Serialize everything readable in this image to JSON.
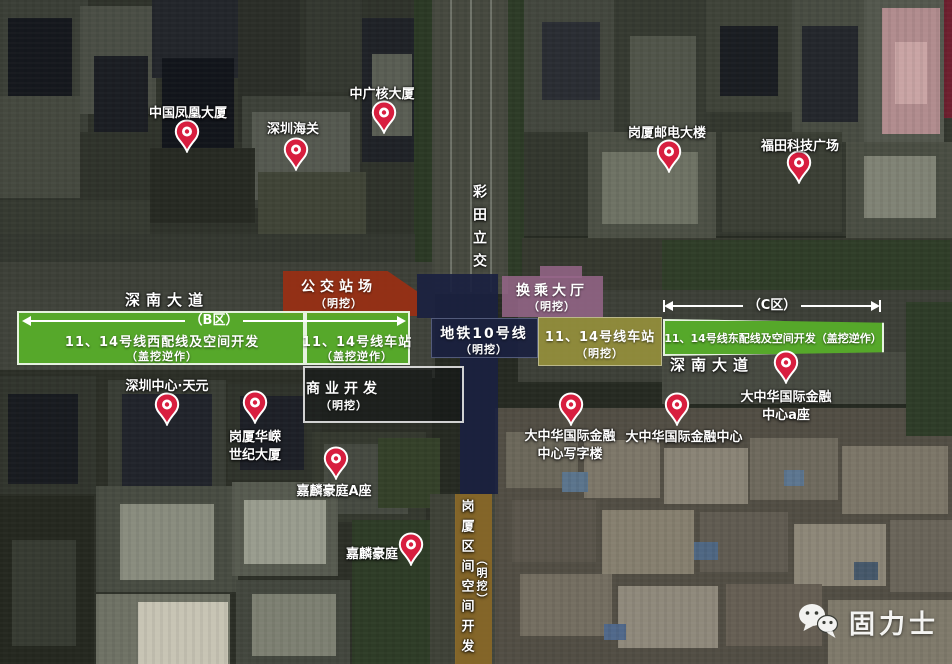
{
  "canvas": {
    "width": 952,
    "height": 664
  },
  "colors": {
    "pin_red": "#d81e3f",
    "zone_green": "rgba(88,177,41,0.92)",
    "zone_red": "rgba(158,45,17,0.88)",
    "zone_mauve": "rgba(151,102,137,0.85)",
    "zone_navy": "rgba(26,33,64,0.92)",
    "zone_olive": "rgba(160,154,60,0.82)",
    "zone_gold": "rgba(148,112,42,0.85)",
    "zone_dark_outline": "rgba(10,12,16,0.42)"
  },
  "background": {
    "base": "#262a22",
    "blocks": [
      [
        0,
        0,
        432,
        292,
        "#2f332b"
      ],
      [
        0,
        0,
        88,
        132,
        "#3b3f37"
      ],
      [
        8,
        18,
        64,
        96,
        "#15181d"
      ],
      [
        80,
        6,
        76,
        108,
        "#4a4e45"
      ],
      [
        94,
        56,
        54,
        76,
        "#1b1e23"
      ],
      [
        152,
        0,
        108,
        78,
        "#23262b"
      ],
      [
        162,
        58,
        72,
        118,
        "#12151b"
      ],
      [
        238,
        0,
        62,
        142,
        "#2b2e28"
      ],
      [
        242,
        96,
        118,
        112,
        "#3d4139"
      ],
      [
        252,
        112,
        98,
        88,
        "#555950"
      ],
      [
        306,
        0,
        56,
        92,
        "#343830"
      ],
      [
        362,
        18,
        54,
        144,
        "#1f2227"
      ],
      [
        372,
        54,
        40,
        82,
        "#5a5e54"
      ],
      [
        0,
        96,
        80,
        102,
        "#45493f"
      ],
      [
        0,
        200,
        150,
        62,
        "#363a31"
      ],
      [
        150,
        148,
        105,
        75,
        "#272a23"
      ],
      [
        258,
        172,
        108,
        62,
        "#404437"
      ],
      [
        414,
        0,
        20,
        292,
        "#2b3925"
      ],
      [
        432,
        0,
        76,
        294,
        "#46493f"
      ],
      [
        450,
        0,
        2,
        292,
        "#70746a"
      ],
      [
        470,
        0,
        2,
        292,
        "#70746a"
      ],
      [
        490,
        0,
        2,
        292,
        "#70746a"
      ],
      [
        508,
        0,
        16,
        290,
        "#2d3b27"
      ],
      [
        524,
        0,
        432,
        236,
        "#33372e"
      ],
      [
        524,
        0,
        92,
        132,
        "#43473e"
      ],
      [
        542,
        22,
        58,
        78,
        "#2a2d33"
      ],
      [
        614,
        0,
        96,
        152,
        "#363a31"
      ],
      [
        630,
        36,
        66,
        92,
        "#51554a"
      ],
      [
        706,
        0,
        88,
        112,
        "#3f4339"
      ],
      [
        720,
        26,
        58,
        70,
        "#1a1d22"
      ],
      [
        792,
        0,
        76,
        142,
        "#484c42"
      ],
      [
        802,
        26,
        56,
        96,
        "#24272c"
      ],
      [
        864,
        0,
        80,
        172,
        "#54584e"
      ],
      [
        882,
        8,
        58,
        126,
        "#b18c8e"
      ],
      [
        895,
        42,
        32,
        62,
        "#c9a4a4"
      ],
      [
        944,
        0,
        8,
        118,
        "#6e1f2e"
      ],
      [
        588,
        132,
        128,
        106,
        "#4c5045"
      ],
      [
        602,
        152,
        96,
        72,
        "#6e7264"
      ],
      [
        722,
        132,
        120,
        100,
        "#3b3f35"
      ],
      [
        846,
        142,
        106,
        96,
        "#4a4e43"
      ],
      [
        864,
        156,
        72,
        62,
        "#808375"
      ],
      [
        0,
        234,
        415,
        58,
        "#343830"
      ],
      [
        0,
        262,
        432,
        32,
        "#3d4038"
      ],
      [
        522,
        238,
        430,
        56,
        "#36392f"
      ],
      [
        662,
        240,
        288,
        54,
        "#2f3d28"
      ],
      [
        0,
        290,
        435,
        88,
        "#40433b"
      ],
      [
        518,
        290,
        434,
        92,
        "#3d4038"
      ],
      [
        662,
        352,
        290,
        52,
        "#474a41"
      ],
      [
        0,
        370,
        432,
        294,
        "#2c2f27"
      ],
      [
        0,
        376,
        96,
        118,
        "#31352d"
      ],
      [
        8,
        394,
        70,
        90,
        "#181b20"
      ],
      [
        108,
        380,
        118,
        126,
        "#393d35"
      ],
      [
        122,
        394,
        90,
        102,
        "#21242b"
      ],
      [
        228,
        384,
        94,
        96,
        "#2f332b"
      ],
      [
        240,
        396,
        64,
        74,
        "#1d2027"
      ],
      [
        312,
        432,
        114,
        90,
        "#35392f"
      ],
      [
        324,
        444,
        84,
        70,
        "#464a41"
      ],
      [
        96,
        486,
        142,
        106,
        "#484c42"
      ],
      [
        120,
        504,
        94,
        76,
        "#898c7e"
      ],
      [
        0,
        496,
        94,
        168,
        "#252820"
      ],
      [
        12,
        540,
        64,
        106,
        "#373b32"
      ],
      [
        96,
        594,
        134,
        70,
        "#6f7265"
      ],
      [
        138,
        602,
        90,
        62,
        "#c7c4b4"
      ],
      [
        232,
        482,
        106,
        94,
        "#575b50"
      ],
      [
        244,
        500,
        82,
        64,
        "#999c8e"
      ],
      [
        236,
        580,
        114,
        84,
        "#43473e"
      ],
      [
        252,
        594,
        84,
        62,
        "#7d8072"
      ],
      [
        352,
        520,
        80,
        144,
        "#2e3c27"
      ],
      [
        378,
        438,
        62,
        70,
        "#344029"
      ],
      [
        430,
        494,
        26,
        170,
        "#3f4238"
      ],
      [
        492,
        494,
        32,
        170,
        "#42453c"
      ],
      [
        495,
        408,
        457,
        256,
        "#524e44"
      ],
      [
        506,
        432,
        72,
        56,
        "#6c685b"
      ],
      [
        584,
        440,
        76,
        58,
        "#7d7769"
      ],
      [
        664,
        448,
        84,
        56,
        "#8a8476"
      ],
      [
        750,
        438,
        88,
        62,
        "#6f6a5e"
      ],
      [
        842,
        446,
        106,
        68,
        "#7c7668"
      ],
      [
        512,
        500,
        84,
        62,
        "#5b564c"
      ],
      [
        602,
        510,
        92,
        64,
        "#867f6f"
      ],
      [
        700,
        512,
        88,
        60,
        "#615c52"
      ],
      [
        794,
        524,
        92,
        62,
        "#8d8778"
      ],
      [
        890,
        520,
        62,
        72,
        "#6a655a"
      ],
      [
        520,
        574,
        92,
        62,
        "#746e61"
      ],
      [
        618,
        586,
        100,
        62,
        "#8f897b"
      ],
      [
        726,
        584,
        96,
        62,
        "#665f54"
      ],
      [
        828,
        600,
        124,
        64,
        "#7f7a6b"
      ],
      [
        562,
        472,
        26,
        20,
        "#5b748c"
      ],
      [
        694,
        542,
        24,
        18,
        "#4f6783"
      ],
      [
        784,
        470,
        20,
        16,
        "#5d7690"
      ],
      [
        854,
        562,
        24,
        18,
        "#46586a"
      ],
      [
        604,
        624,
        22,
        16,
        "#50688a"
      ],
      [
        906,
        302,
        46,
        134,
        "#2e3c28"
      ]
    ]
  },
  "zones": [
    {
      "name": "bus-depot-zone",
      "color": "rgba(158,45,17,0.88)",
      "parts": [
        {
          "x": 283,
          "y": 271,
          "w": 134,
          "h": 45,
          "clip": "polygon(0% 0%,78% 0%,100% 45%,100% 100%,0% 100%)"
        }
      ],
      "texts": [
        {
          "t": "公交站场",
          "x": 339,
          "y": 276,
          "s": 14,
          "ls": 5
        },
        {
          "t": "（明挖）",
          "x": 339,
          "y": 295,
          "s": 11,
          "ls": 1
        }
      ]
    },
    {
      "name": "transfer-hall-zone",
      "color": "rgba(151,102,137,0.85)",
      "parts": [
        {
          "x": 540,
          "y": 266,
          "w": 42,
          "h": 12
        },
        {
          "x": 502,
          "y": 276,
          "w": 101,
          "h": 41
        }
      ],
      "texts": [
        {
          "t": "换乘大厅",
          "x": 552,
          "y": 280,
          "s": 14,
          "ls": 4
        },
        {
          "t": "（明挖）",
          "x": 552,
          "y": 298,
          "s": 11,
          "ls": 1
        }
      ]
    },
    {
      "name": "west-dev-zone",
      "color": "rgba(88,177,41,0.92)",
      "parts": [
        {
          "x": 17,
          "y": 311,
          "w": 288,
          "h": 54,
          "border": "2px solid rgba(255,255,255,0.85)"
        }
      ],
      "texts": [
        {
          "t": "11、14号线西配线及空间开发",
          "x": 162,
          "y": 331,
          "s": 13,
          "ls": 1
        },
        {
          "t": "（盖挖逆作）",
          "x": 162,
          "y": 348,
          "s": 11,
          "ls": 1
        }
      ]
    },
    {
      "name": "west-station-zone",
      "color": "rgba(88,177,41,0.92)",
      "parts": [
        {
          "x": 305,
          "y": 311,
          "w": 105,
          "h": 54,
          "border": "2px solid rgba(255,255,255,0.85)"
        }
      ],
      "texts": [
        {
          "t": "11、14号线车站",
          "x": 357,
          "y": 331,
          "s": 13,
          "ls": 1
        },
        {
          "t": "（盖挖逆作）",
          "x": 357,
          "y": 348,
          "s": 11,
          "ls": 1
        }
      ]
    },
    {
      "name": "metro-line10-zone",
      "color": "rgba(26,33,64,0.92)",
      "parts": [
        {
          "x": 417,
          "y": 274,
          "w": 81,
          "h": 44
        },
        {
          "x": 431,
          "y": 318,
          "w": 107,
          "h": 40,
          "border": "1px solid rgba(150,160,195,0.45)"
        },
        {
          "x": 460,
          "y": 358,
          "w": 38,
          "h": 136
        }
      ],
      "texts": [
        {
          "t": "地铁10号线",
          "x": 484,
          "y": 323,
          "s": 14,
          "ls": 2
        },
        {
          "t": "（明挖）",
          "x": 484,
          "y": 341,
          "s": 11,
          "ls": 1
        }
      ]
    },
    {
      "name": "east-station-zone",
      "color": "rgba(160,154,60,0.82)",
      "parts": [
        {
          "x": 538,
          "y": 317,
          "w": 124,
          "h": 49,
          "border": "1px solid rgba(255,255,255,0.4)"
        }
      ],
      "texts": [
        {
          "t": "11、14号线车站",
          "x": 600,
          "y": 326,
          "s": 13,
          "ls": 1
        },
        {
          "t": "（明挖）",
          "x": 600,
          "y": 345,
          "s": 11,
          "ls": 1
        }
      ]
    },
    {
      "name": "east-dev-zone",
      "color": "rgba(88,177,41,0.92)",
      "parts": [
        {
          "x": 663,
          "y": 319,
          "w": 221,
          "h": 37,
          "border": "2px solid rgba(255,255,255,0.85)",
          "clip": "polygon(0% 0%,100% 10%,100% 90%,0% 100%)"
        }
      ],
      "texts": [
        {
          "t": "11、14号线东配线及空间开发（盖挖逆作）",
          "x": 773,
          "y": 330,
          "s": 11,
          "ls": 0
        }
      ]
    },
    {
      "name": "commercial-dev-zone",
      "color": "rgba(10,12,16,0.42)",
      "parts": [
        {
          "x": 303,
          "y": 366,
          "w": 161,
          "h": 57,
          "border": "2px solid rgba(242,242,242,0.85)"
        }
      ],
      "texts": [
        {
          "t": "商业开发",
          "x": 344,
          "y": 378,
          "s": 14,
          "ls": 5
        },
        {
          "t": "（明挖）",
          "x": 344,
          "y": 397,
          "s": 11,
          "ls": 1
        }
      ]
    },
    {
      "name": "gangxia-interval-zone",
      "color": "rgba(148,112,42,0.85)",
      "parts": [
        {
          "x": 455,
          "y": 494,
          "w": 37,
          "h": 170
        }
      ],
      "texts": []
    }
  ],
  "arrows": [
    {
      "name": "zone-b-extent-arrow",
      "label": "（B区）",
      "x1": 22,
      "x2": 406,
      "y": 321,
      "ticks": false,
      "shadow": false
    },
    {
      "name": "zone-c-extent-arrow",
      "label": "（C区）",
      "x1": 664,
      "x2": 880,
      "y": 306,
      "ticks": true,
      "shadow": true
    }
  ],
  "road_labels": [
    {
      "t": "深南大道",
      "x": 167,
      "y": 289,
      "s": 15,
      "ls": 6
    },
    {
      "t": "深南大道",
      "x": 712,
      "y": 354,
      "s": 15,
      "ls": 6
    }
  ],
  "vertical_labels": [
    {
      "t": "彩田立交",
      "x": 479,
      "y": 184,
      "s": 14,
      "gap": 9
    },
    {
      "t": "岗厦区间空间开发",
      "x": 466,
      "y": 499,
      "s": 13,
      "gap": 7
    },
    {
      "t": "（明挖）",
      "x": 481,
      "y": 554,
      "s": 11,
      "gap": 2
    }
  ],
  "pins": [
    {
      "tip": [
        187,
        153
      ],
      "label": {
        "lines": [
          "中国凤凰大厦"
        ],
        "x": 188,
        "y": 105
      }
    },
    {
      "tip": [
        296,
        171
      ],
      "label": {
        "lines": [
          "深圳海关"
        ],
        "x": 293,
        "y": 121
      }
    },
    {
      "tip": [
        384,
        134
      ],
      "label": {
        "lines": [
          "中广核大厦"
        ],
        "x": 382,
        "y": 86
      }
    },
    {
      "tip": [
        669,
        173
      ],
      "label": {
        "lines": [
          "岗厦邮电大楼"
        ],
        "x": 667,
        "y": 125
      }
    },
    {
      "tip": [
        799,
        184
      ],
      "label": {
        "lines": [
          "福田科技广场"
        ],
        "x": 800,
        "y": 138
      }
    },
    {
      "tip": [
        167,
        426
      ],
      "label": {
        "lines": [
          "深圳中心·天元"
        ],
        "x": 167,
        "y": 378
      }
    },
    {
      "tip": [
        255,
        424
      ],
      "label": {
        "lines": [
          "岗厦华嵘",
          "世纪大厦"
        ],
        "x": 255,
        "y": 429
      }
    },
    {
      "tip": [
        336,
        480
      ],
      "label": {
        "lines": [
          "嘉麟豪庭A座"
        ],
        "x": 334,
        "y": 483
      }
    },
    {
      "tip": [
        411,
        566
      ],
      "label": {
        "lines": [
          "嘉麟豪庭"
        ],
        "x": 372,
        "y": 546
      }
    },
    {
      "tip": [
        571,
        426
      ],
      "label": {
        "lines": [
          "大中华国际金融",
          "中心写字楼"
        ],
        "x": 570,
        "y": 428
      }
    },
    {
      "tip": [
        677,
        426
      ],
      "label": {
        "lines": [
          "大中华国际金融中心"
        ],
        "x": 684,
        "y": 429
      }
    },
    {
      "tip": [
        786,
        384
      ],
      "label": {
        "lines": [
          "大中华国际金融",
          "中心a座"
        ],
        "x": 786,
        "y": 389
      }
    }
  ],
  "logo": {
    "text": "固力士"
  }
}
